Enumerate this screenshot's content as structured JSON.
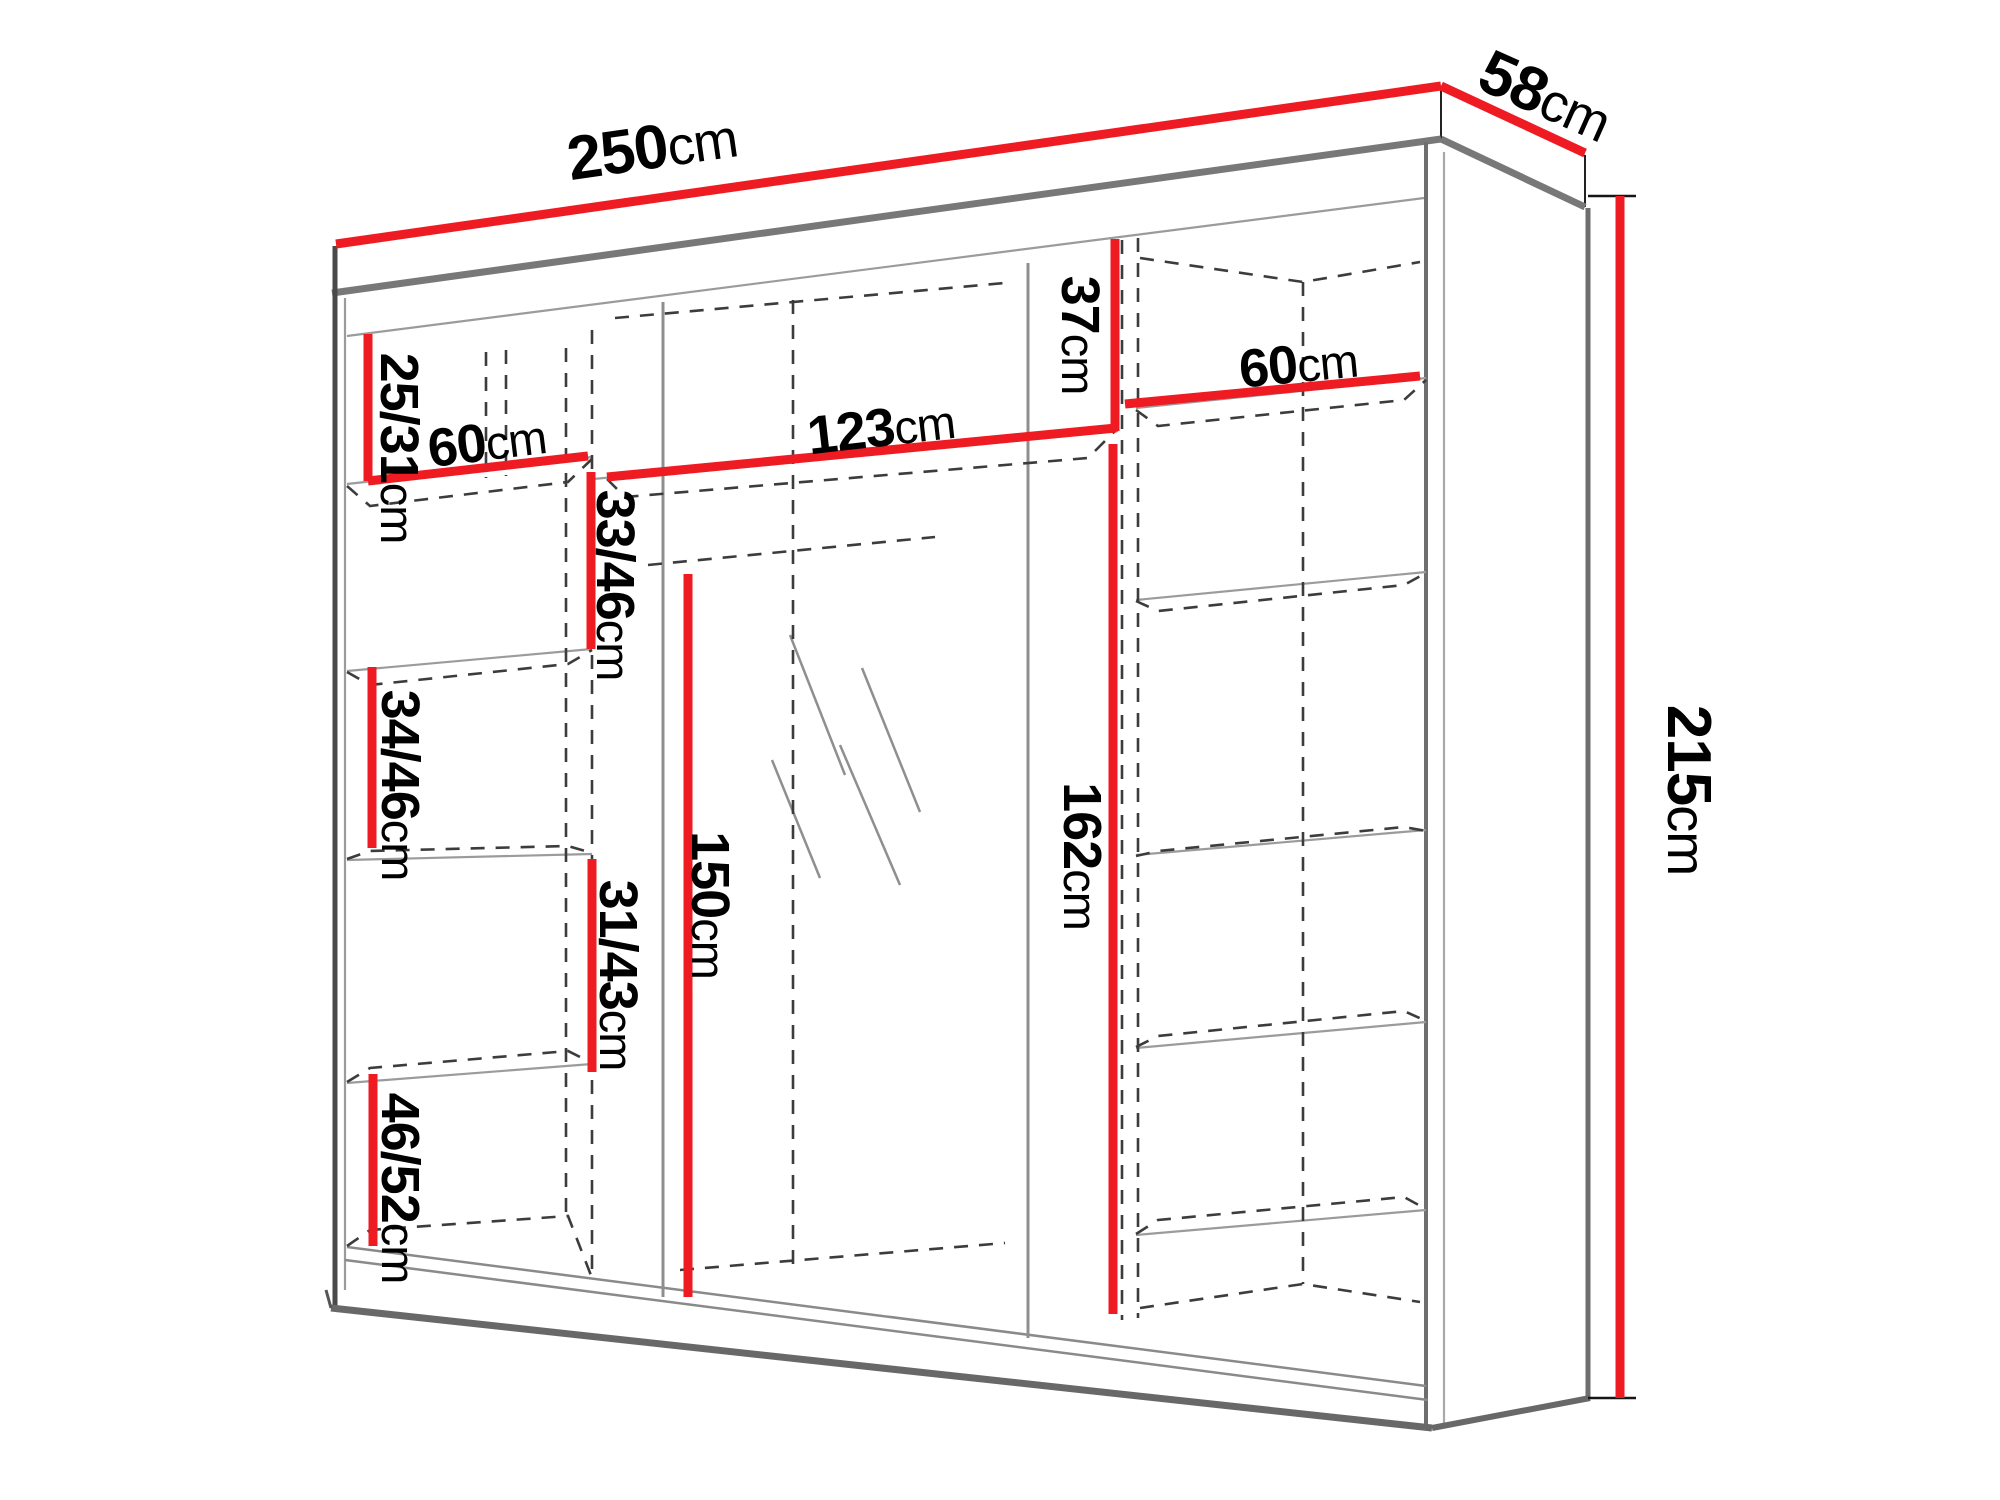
{
  "diagram": {
    "type": "furniture-dimension-drawing",
    "subject": "three-door sliding wardrobe with mirror, perspective line drawing with red dimension lines",
    "colors": {
      "background": "#ffffff",
      "dimension_line": "#ee1c22",
      "label_text": "#000000",
      "structure_line": "#6e6e6e",
      "hidden_line": "#3c3c3c"
    },
    "dimensions": {
      "width": {
        "value": "250",
        "unit": "cm"
      },
      "depth": {
        "value": "58",
        "unit": "cm"
      },
      "height": {
        "value": "215",
        "unit": "cm"
      },
      "left_top_gap": {
        "value": "25/31",
        "unit": "cm"
      },
      "left_width": {
        "value": "60",
        "unit": "cm"
      },
      "left_gap_2": {
        "value": "33/46",
        "unit": "cm"
      },
      "left_gap_3": {
        "value": "34/46",
        "unit": "cm"
      },
      "left_gap_4": {
        "value": "31/43",
        "unit": "cm"
      },
      "left_gap_5": {
        "value": "46/52",
        "unit": "cm"
      },
      "center_width": {
        "value": "123",
        "unit": "cm"
      },
      "center_top_gap": {
        "value": "37",
        "unit": "cm"
      },
      "center_height": {
        "value": "162",
        "unit": "cm"
      },
      "mirror_height": {
        "value": "150",
        "unit": "cm"
      },
      "right_width": {
        "value": "60",
        "unit": "cm"
      }
    }
  }
}
